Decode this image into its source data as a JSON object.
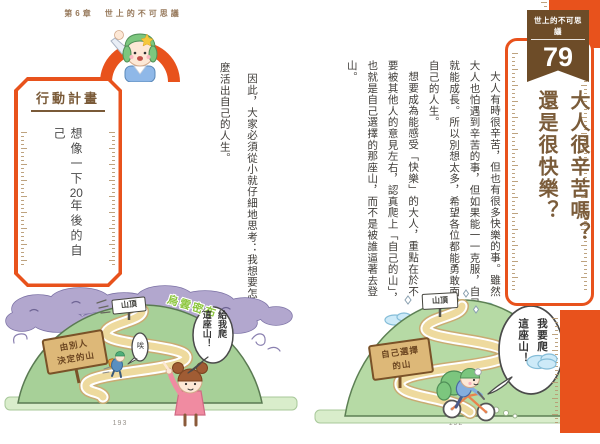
{
  "left_page": {
    "header": "第6章　世上的不可思議",
    "action_plan": {
      "title": "行動計畫",
      "content_prefix": "想像一下",
      "content_number": "20",
      "content_suffix": "年後的自己"
    },
    "body": [
      "因此，大家必須從小就仔細地思考：我想要怎",
      "麼活出自己的人生。"
    ],
    "illustration": {
      "cloud_label": "烏雲密布",
      "summit_sign": "山頂",
      "wooden_sign_line1": "由別人",
      "wooden_sign_line2": "決定的山",
      "climber_sigh": "唉",
      "bubble_line1": "給我爬",
      "bubble_line2": "這座山！"
    },
    "page_number": "193"
  },
  "right_page": {
    "badge": {
      "series": "世上的不可思議",
      "number": "79"
    },
    "title": [
      "大人很辛苦嗎？",
      "還是很快樂？"
    ],
    "body": [
      "大人有時很辛苦，但也有很多快樂的事。雖然",
      "大人也怕遇到辛苦的事，但如果能一一克服，自己",
      "就能成長。所以別想太多，希望各位都能勇敢面對",
      "自己的人生。",
      "想要成為能感受「快樂」的大人，重點在於不",
      "要被其他人的意見左右，認真爬上「自己的山」，",
      "也就是自己選擇的那座山，而不是被誰逼著去登",
      "山。"
    ],
    "illustration": {
      "summit_sign": "山頂",
      "wooden_sign_line1": "自己選擇",
      "wooden_sign_line2": "的山",
      "bubble_line1": "我要爬",
      "bubble_line2": "這座山！",
      "music_note": "♪"
    },
    "page_number": "192"
  },
  "colors": {
    "accent_orange": "#e8521c",
    "banner_brown": "#6d4c28",
    "title_brown": "#7b5c3a",
    "body_text": "#3e3b37",
    "mountain_green_right": "#b6daa5",
    "mountain_green_left": "#a7d098",
    "storm_cloud_purple": "#b2a7ce",
    "cloud_label_green": "#8cc63e",
    "path_tan": "#eeda9e"
  }
}
